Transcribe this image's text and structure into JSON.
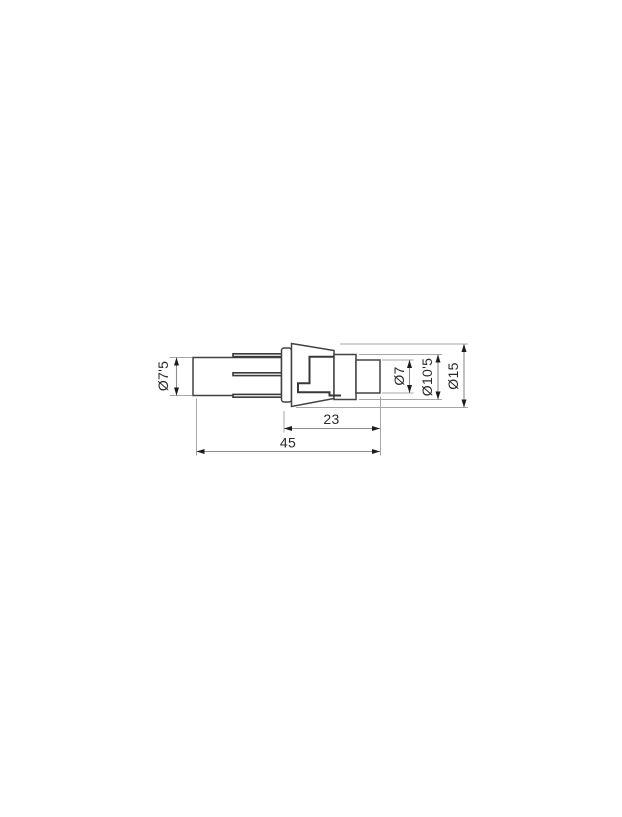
{
  "drawing": {
    "type": "technical-dimension-drawing",
    "subject": "cylindrical connector plug, side view",
    "dimensions": {
      "barrel_diameter": {
        "label": "Ø7'5",
        "value": 7.5,
        "orientation": "vertical-left"
      },
      "tip_diameter": {
        "label": "Ø7",
        "value": 7,
        "orientation": "vertical-right"
      },
      "sleeve_diameter": {
        "label": "Ø10'5",
        "value": 10.5,
        "orientation": "vertical-right"
      },
      "flange_diameter": {
        "label": "Ø15",
        "value": 15,
        "orientation": "vertical-right"
      },
      "front_section_length": {
        "label": "23",
        "value": 23,
        "orientation": "horizontal-bottom"
      },
      "overall_length": {
        "label": "45",
        "value": 45,
        "orientation": "horizontal-bottom"
      }
    },
    "colors": {
      "background": "#ffffff",
      "part_outline": "#424242",
      "inner_detail": "#383838",
      "dimension_line": "#8d8d8d",
      "extension_line": "#a6a6a6",
      "arrowhead": "#1c1c1c",
      "label_text": "#2b2b2b"
    }
  }
}
